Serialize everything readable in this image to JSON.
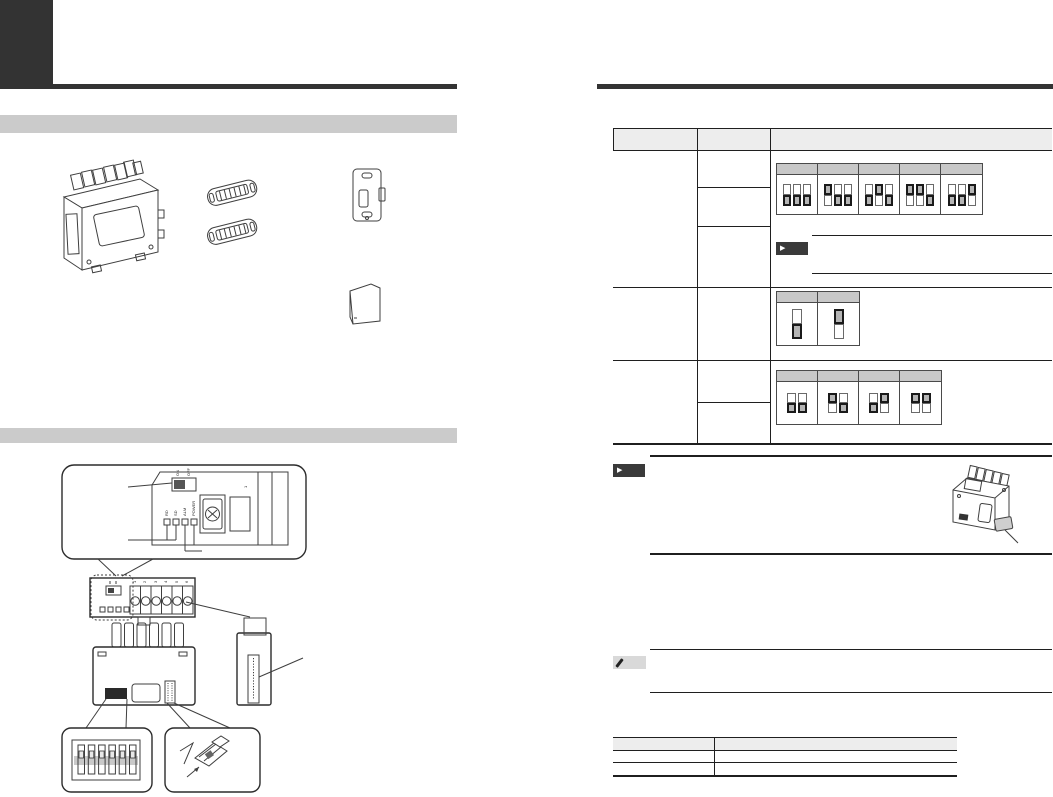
{
  "page": {
    "kind": "instruction-manual-scan",
    "note": "text content not legible in scan; structural elements only"
  },
  "colors": {
    "corner_tab": "#333333",
    "top_rule": "#333333",
    "section_bar": "#cbcbcb",
    "table_header": "#ededed",
    "dip_header": "#c8c8c8",
    "dip_active": "#b5b5b5",
    "note_badge_bg": "#3a3a3a",
    "memo_badge_bg": "#d9d9d9"
  },
  "icons": {
    "note_badge": "play-arrow-note-icon",
    "memo_badge": "pencil-memo-icon"
  },
  "sections": [
    {
      "id": "accessories",
      "label": ""
    },
    {
      "id": "part-names-settings",
      "label": ""
    }
  ],
  "accessories": {
    "items": [
      "main-unit",
      "cable-clamp-x2",
      "mounting-plate",
      "sd-card"
    ]
  },
  "panel_callout": {
    "switch_labels": [
      "ON",
      "OFF"
    ],
    "led_labels": [
      "RD",
      "SD",
      "ALM",
      "POWER"
    ],
    "terminal_label": "1"
  },
  "front_view": {
    "terminal_numbers": [
      "1",
      "2",
      "3",
      "4",
      "5",
      "6"
    ]
  },
  "rear_view": {
    "features": [
      "usb-port",
      "pin-connector"
    ]
  },
  "callout_boxes": [
    {
      "id": "dip-switch-bank",
      "content": "6-position DIP switch"
    },
    {
      "id": "jumper-plug",
      "content": "short-circuit connector with arrow"
    }
  ],
  "settings_table": {
    "columns": [
      {
        "label": ""
      },
      {
        "label": ""
      },
      {
        "label": ""
      }
    ],
    "rows": [
      {
        "sub_rows": 3,
        "dip_group": {
          "switch_count": 3,
          "options": [
            {
              "label": "",
              "switches": [
                "down",
                "down",
                "down"
              ]
            },
            {
              "label": "",
              "switches": [
                "up",
                "down",
                "down"
              ]
            },
            {
              "label": "",
              "switches": [
                "down",
                "up",
                "down"
              ]
            },
            {
              "label": "",
              "switches": [
                "up",
                "up",
                "down"
              ]
            },
            {
              "label": "",
              "switches": [
                "down",
                "down",
                "up"
              ]
            }
          ]
        },
        "note": {
          "present": true,
          "text": ""
        }
      },
      {
        "sub_rows": 1,
        "dip_group": {
          "switch_count": 1,
          "options": [
            {
              "label": "",
              "switches": [
                "down"
              ]
            },
            {
              "label": "",
              "switches": [
                "up"
              ]
            }
          ]
        }
      },
      {
        "sub_rows": 2,
        "dip_group": {
          "switch_count": 2,
          "options": [
            {
              "label": "",
              "switches": [
                "down",
                "down"
              ]
            },
            {
              "label": "",
              "switches": [
                "up",
                "down"
              ]
            },
            {
              "label": "",
              "switches": [
                "down",
                "up"
              ]
            },
            {
              "label": "",
              "switches": [
                "up",
                "up"
              ]
            }
          ]
        }
      }
    ]
  },
  "notes": [
    {
      "type": "note",
      "badge": "arrow",
      "text": ""
    },
    {
      "type": "memo",
      "badge": "pencil",
      "text": ""
    }
  ],
  "sd_note_illustration": {
    "item": "unit-with-sd-card"
  },
  "bottom_table": {
    "columns": [
      {
        "label": ""
      },
      {
        "label": ""
      }
    ],
    "rows": [
      {
        "cells": [
          "",
          ""
        ]
      },
      {
        "cells": [
          "",
          ""
        ]
      }
    ]
  }
}
